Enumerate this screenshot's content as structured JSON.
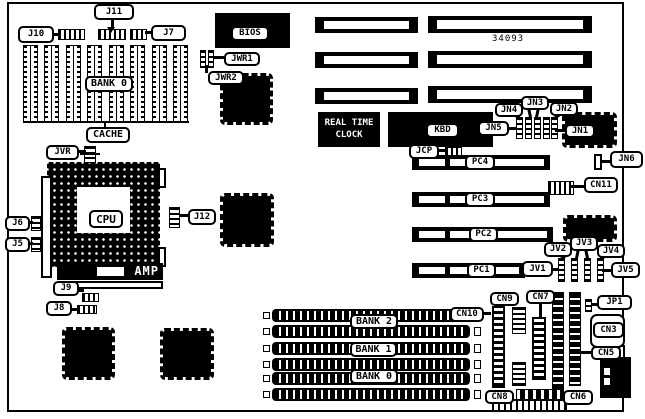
{
  "diagram": {
    "type": "motherboard-layout",
    "part_number": "34093",
    "rtc_label": "REAL TIME\nCLOCK",
    "amp_label": "AMP",
    "labels": [
      {
        "name": "j10",
        "text": "J10",
        "x": 18,
        "y": 26,
        "w": 36,
        "h": 17
      },
      {
        "name": "j11",
        "text": "J11",
        "x": 94,
        "y": 4,
        "w": 40,
        "h": 16
      },
      {
        "name": "j7",
        "text": "J7",
        "x": 151,
        "y": 25,
        "w": 35,
        "h": 16
      },
      {
        "name": "bank0-cache",
        "text": "BANK 0",
        "x": 85,
        "y": 76,
        "w": 48,
        "h": 16,
        "fs": 10
      },
      {
        "name": "cache",
        "text": "CACHE",
        "x": 86,
        "y": 127,
        "w": 44,
        "h": 16,
        "fs": 10
      },
      {
        "name": "jvr",
        "text": "JVR",
        "x": 46,
        "y": 145,
        "w": 33,
        "h": 15
      },
      {
        "name": "jwr1",
        "text": "JWR1",
        "x": 224,
        "y": 52,
        "w": 36,
        "h": 14
      },
      {
        "name": "jwr2",
        "text": "JWR2",
        "x": 208,
        "y": 71,
        "w": 36,
        "h": 14
      },
      {
        "name": "bios",
        "text": "BIOS",
        "x": 231,
        "y": 26,
        "w": 38,
        "h": 15
      },
      {
        "name": "j6",
        "text": "J6",
        "x": 5,
        "y": 216,
        "w": 25,
        "h": 15
      },
      {
        "name": "j5",
        "text": "J5",
        "x": 5,
        "y": 237,
        "w": 25,
        "h": 15
      },
      {
        "name": "cpu",
        "text": "CPU",
        "x": 89,
        "y": 210,
        "w": 34,
        "h": 18,
        "fs": 11
      },
      {
        "name": "j12",
        "text": "J12",
        "x": 188,
        "y": 209,
        "w": 28,
        "h": 16
      },
      {
        "name": "j9",
        "text": "J9",
        "x": 53,
        "y": 281,
        "w": 26,
        "h": 15
      },
      {
        "name": "j8",
        "text": "J8",
        "x": 46,
        "y": 301,
        "w": 26,
        "h": 15
      },
      {
        "name": "kbd",
        "text": "KBD",
        "x": 426,
        "y": 123,
        "w": 33,
        "h": 15
      },
      {
        "name": "jcp",
        "text": "JCP",
        "x": 409,
        "y": 144,
        "w": 30,
        "h": 15
      },
      {
        "name": "jn5",
        "text": "JN5",
        "x": 478,
        "y": 121,
        "w": 31,
        "h": 15
      },
      {
        "name": "jn4",
        "text": "JN4",
        "x": 495,
        "y": 103,
        "w": 28,
        "h": 14
      },
      {
        "name": "jn3",
        "text": "JN3",
        "x": 521,
        "y": 96,
        "w": 28,
        "h": 14
      },
      {
        "name": "jn2",
        "text": "JN2",
        "x": 550,
        "y": 102,
        "w": 28,
        "h": 14
      },
      {
        "name": "jn1",
        "text": "JN1",
        "x": 565,
        "y": 124,
        "w": 30,
        "h": 14
      },
      {
        "name": "jn6",
        "text": "JN6",
        "x": 610,
        "y": 151,
        "w": 33,
        "h": 17
      },
      {
        "name": "cn11",
        "text": "CN11",
        "x": 584,
        "y": 177,
        "w": 34,
        "h": 16
      },
      {
        "name": "pc4",
        "text": "PC4",
        "x": 465,
        "y": 155,
        "w": 30,
        "h": 15
      },
      {
        "name": "pc3",
        "text": "PC3",
        "x": 465,
        "y": 192,
        "w": 30,
        "h": 15
      },
      {
        "name": "pc2",
        "text": "PC2",
        "x": 469,
        "y": 227,
        "w": 29,
        "h": 15
      },
      {
        "name": "pc1",
        "text": "PC1",
        "x": 467,
        "y": 263,
        "w": 29,
        "h": 15
      },
      {
        "name": "jv1",
        "text": "JV1",
        "x": 522,
        "y": 261,
        "w": 31,
        "h": 16
      },
      {
        "name": "jv2",
        "text": "JV2",
        "x": 544,
        "y": 242,
        "w": 28,
        "h": 15
      },
      {
        "name": "jv3",
        "text": "JV3",
        "x": 570,
        "y": 236,
        "w": 28,
        "h": 15
      },
      {
        "name": "jv4",
        "text": "JV4",
        "x": 597,
        "y": 244,
        "w": 28,
        "h": 14
      },
      {
        "name": "jv5",
        "text": "JV5",
        "x": 611,
        "y": 262,
        "w": 29,
        "h": 16
      },
      {
        "name": "cn10",
        "text": "CN10",
        "x": 450,
        "y": 307,
        "w": 34,
        "h": 15
      },
      {
        "name": "cn9",
        "text": "CN9",
        "x": 490,
        "y": 292,
        "w": 29,
        "h": 14
      },
      {
        "name": "cn7",
        "text": "CN7",
        "x": 526,
        "y": 290,
        "w": 29,
        "h": 14
      },
      {
        "name": "jp1",
        "text": "JP1",
        "x": 597,
        "y": 295,
        "w": 35,
        "h": 15
      },
      {
        "name": "cn3",
        "text": "CN3",
        "x": 593,
        "y": 322,
        "w": 31,
        "h": 16
      },
      {
        "name": "cn5",
        "text": "CN5",
        "x": 591,
        "y": 346,
        "w": 30,
        "h": 14
      },
      {
        "name": "cn8",
        "text": "CN8",
        "x": 485,
        "y": 390,
        "w": 29,
        "h": 14
      },
      {
        "name": "cn6",
        "text": "CN6",
        "x": 563,
        "y": 390,
        "w": 30,
        "h": 15
      },
      {
        "name": "bank2",
        "text": "BANK 2",
        "x": 350,
        "y": 314,
        "w": 48,
        "h": 15,
        "fs": 10
      },
      {
        "name": "bank1",
        "text": "BANK 1",
        "x": 350,
        "y": 342,
        "w": 47,
        "h": 15,
        "fs": 10
      },
      {
        "name": "bank0-simm",
        "text": "BANK 0",
        "x": 350,
        "y": 369,
        "w": 48,
        "h": 15,
        "fs": 10
      }
    ]
  }
}
